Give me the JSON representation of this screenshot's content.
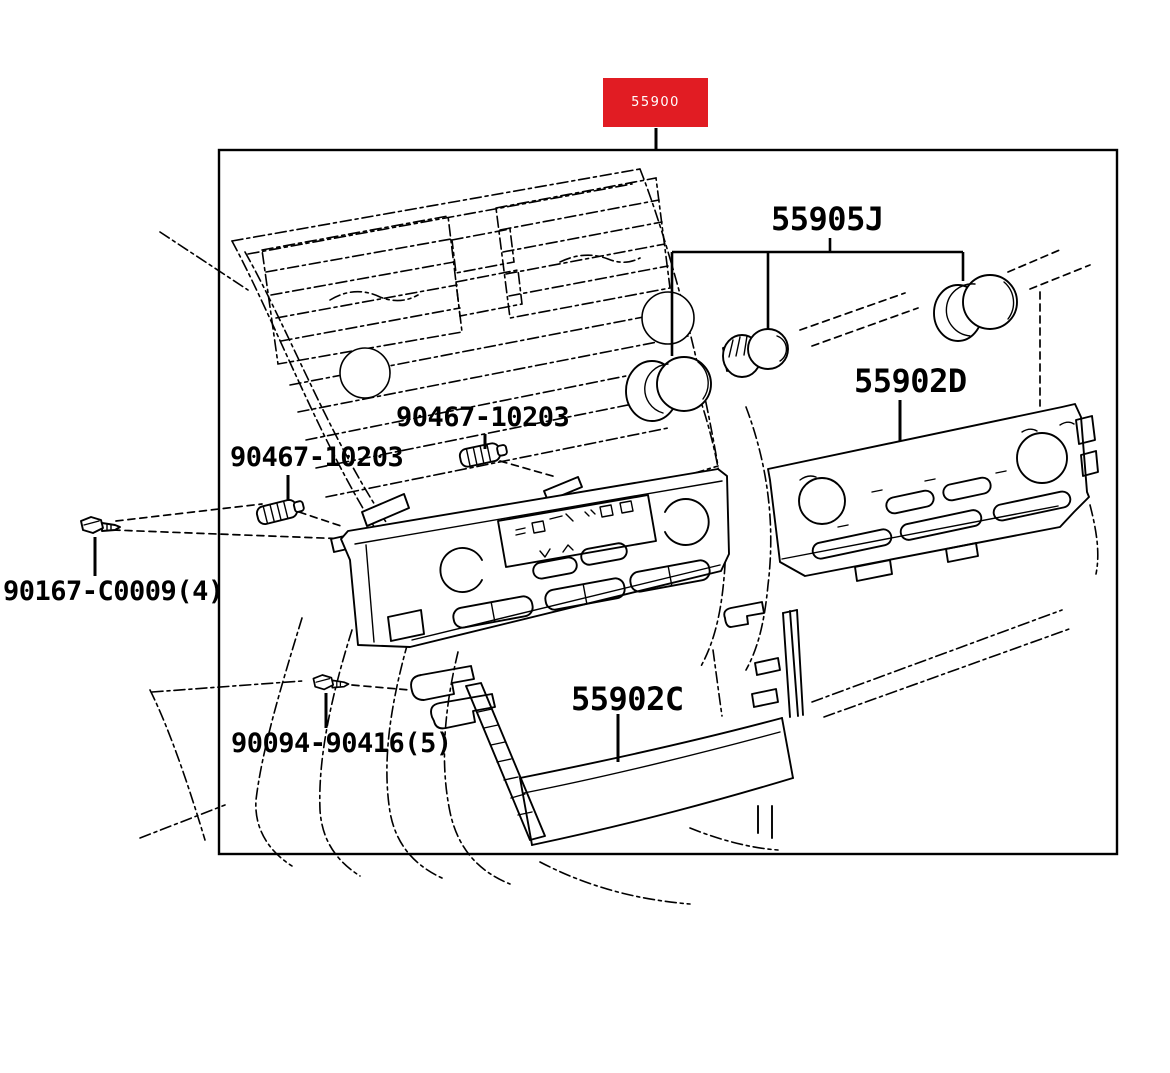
{
  "callout": {
    "part_number": "55900"
  },
  "part_labels": {
    "knob_set": "55905J",
    "control_faceplate": "55902D",
    "lower_panel": "55902C",
    "fastener_upper": "90467-10203",
    "fastener_lower": "90467-10203",
    "screw_left": "90167-C0009(4)",
    "screw_bottom": "90094-90416(5)"
  },
  "colors": {
    "highlight_red": "#e11c23",
    "line": "#000000",
    "background": "#ffffff"
  }
}
